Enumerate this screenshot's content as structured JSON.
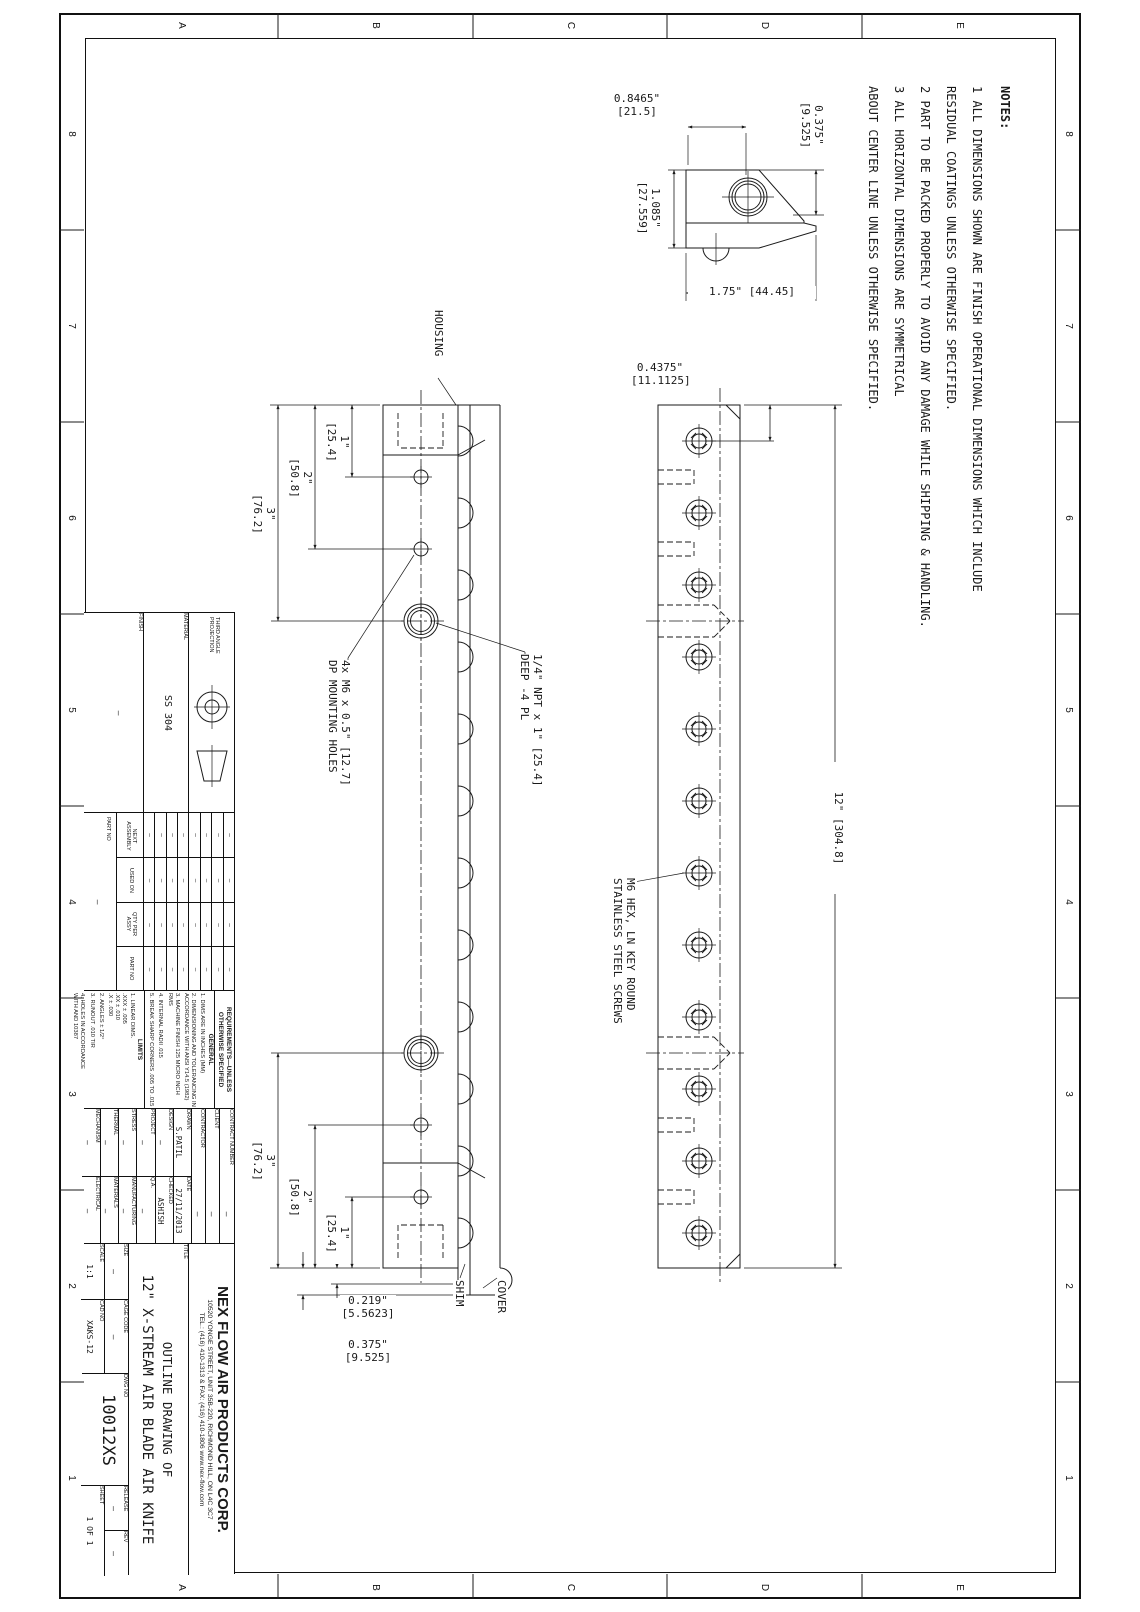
{
  "border": {
    "letters": [
      "E",
      "D",
      "C",
      "B",
      "A"
    ],
    "numbers": [
      "8",
      "7",
      "6",
      "5",
      "4",
      "3",
      "2",
      "1"
    ]
  },
  "notes": {
    "heading": "NOTES:",
    "body": "1   ALL DIMENSIONS SHOWN ARE FINISH OPERATIONAL DIMENSIONS WHICH INCLUDE\n    RESIDUAL COATINGS UNLESS OTHERWISE SPECIFIED.\n2   PART TO BE PACKED PROPERLY TO AVOID ANY DAMAGE WHILE SHIPPING & HANDLING.\n3   ALL HORIZONTAL DIMENSIONS ARE SYMMETRICAL\n    ABOUT CENTER LINE UNLESS OTHERWISE SPECIFIED."
  },
  "detail_view": {
    "width_dim": "0.8465\"\n[21.5]",
    "height_dim": "1.085\"\n[27.559]",
    "top_dim": "0.375\"\n[9.525]",
    "base_dim": "1.75\" [44.45]"
  },
  "front_view": {
    "housing_label": "HOUSING",
    "shim_label": "SHIM",
    "cover_label": "COVER",
    "dim_1": "1\"\n[25.4]",
    "dim_2": "2\"\n[50.8]",
    "dim_3": "3\"\n[76.2]",
    "npt_note": "1/4\" NPT x 1\" [25.4]\nDEEP -4 PL",
    "mount_note": "4x M6 x 0.5\" [12.7]\nDP MOUNTING HOLES",
    "shim_dim": "0.219\"\n[5.5623]",
    "cover_dim": "0.375\"\n[9.525]"
  },
  "top_view": {
    "length_dim": "12\" [304.8]",
    "end_dim": "0.4375\"\n[11.1125]",
    "screw_note": "M6 HEX, LN KEY ROUND\nSTAINLESS STEEL SCREWS"
  },
  "projection_block": {
    "label": "THIRD ANGLE\nPROJECTION",
    "material_label": "MATERIAL",
    "material_value": "SS 304",
    "finish_label": "FINISH",
    "finish_value": "—"
  },
  "application_block": {
    "columns": [
      "NEXT\nASSEMBLY",
      "USED ON",
      "QTY PER\nASSY",
      "PART NO"
    ],
    "dash": "—",
    "part_no_label": "PART NO",
    "part_no_value": "—"
  },
  "requirements": {
    "heading": "REQUIREMENTS—UNLESS\nOTHERWISE SPECIFIED",
    "general_label": "GENERAL",
    "general_items": [
      "1. DIMS ARE IN INCHES (MM)",
      "2. DIMENSIONING AND TOLERANCING IN\nACCORDANCE WITH ANSI Y14.5 (1982)",
      "3. MACHINE FINISH 125 MICRO INCH RMS",
      "4. INTERNAL RADII .015",
      "5. BREAK SHARP CORNERS .005 TO .015"
    ],
    "limits_label": "LIMITS",
    "limits_items": [
      "1. LINEAR DIMS.\n.XXX ± .005\n.XX ± .010\n.X ± .030",
      "2. ANGLES ± 1/2°",
      "3. RUNOUT .010 TIR",
      "4. HOLES IN ACCORDANCE\nWITH AND 10387"
    ]
  },
  "signoff": {
    "contract_label": "CONTRACT NUMBER",
    "contract_value": "—",
    "client_label": "CLIENT",
    "client_value": "—",
    "contractor_label": "CONTRACTOR",
    "contractor_value": "—",
    "rows": [
      {
        "l1": "DRAWN",
        "v1": "S.PATIL",
        "l2": "DATE",
        "v2": "27/11/2013"
      },
      {
        "l1": "DESIGN",
        "v1": "—",
        "l2": "CHECKED",
        "v2": "ASHISH"
      },
      {
        "l1": "PROJECT",
        "v1": "—",
        "l2": "Q.A.",
        "v2": "—"
      },
      {
        "l1": "STRESS",
        "v1": "—",
        "l2": "MANUFACTURING",
        "v2": "—"
      },
      {
        "l1": "THERMAL",
        "v1": "—",
        "l2": "MATERIALS",
        "v2": "—"
      },
      {
        "l1": "MECHANISM",
        "v1": "—",
        "l2": "ELECTRICAL",
        "v2": "—"
      }
    ]
  },
  "title_block": {
    "company": "NEX FLOW AIR PRODUCTS CORP.",
    "address": "10520 YONGE STREET, UNIT 35B-220, RICHMOND HILL, ON L4C 3C7",
    "contact": "TEL.: (416) 410-1313 & FAX: (416) 410-1806   www.nex-flow.com",
    "title_label": "TITLE",
    "title_line1": "OUTLINE DRAWING OF",
    "title_line2": "12\" X-STREAM AIR BLADE AIR KNIFE",
    "size_label": "SIZE",
    "size_value": "—",
    "cage_label": "CAGE CODE",
    "cage_value": "—",
    "dwg_label": "DWG NO",
    "dwg_value": "10012XS",
    "release_label": "RELEASE",
    "release_value": "—",
    "rev_label": "REV",
    "rev_value": "—",
    "scale_label": "SCALE",
    "scale_value": "1:1",
    "cad_label": "CAD NO",
    "cad_value": "XAKS-12",
    "sheet_label": "SHEET",
    "sheet_value": "1 OF 1"
  }
}
